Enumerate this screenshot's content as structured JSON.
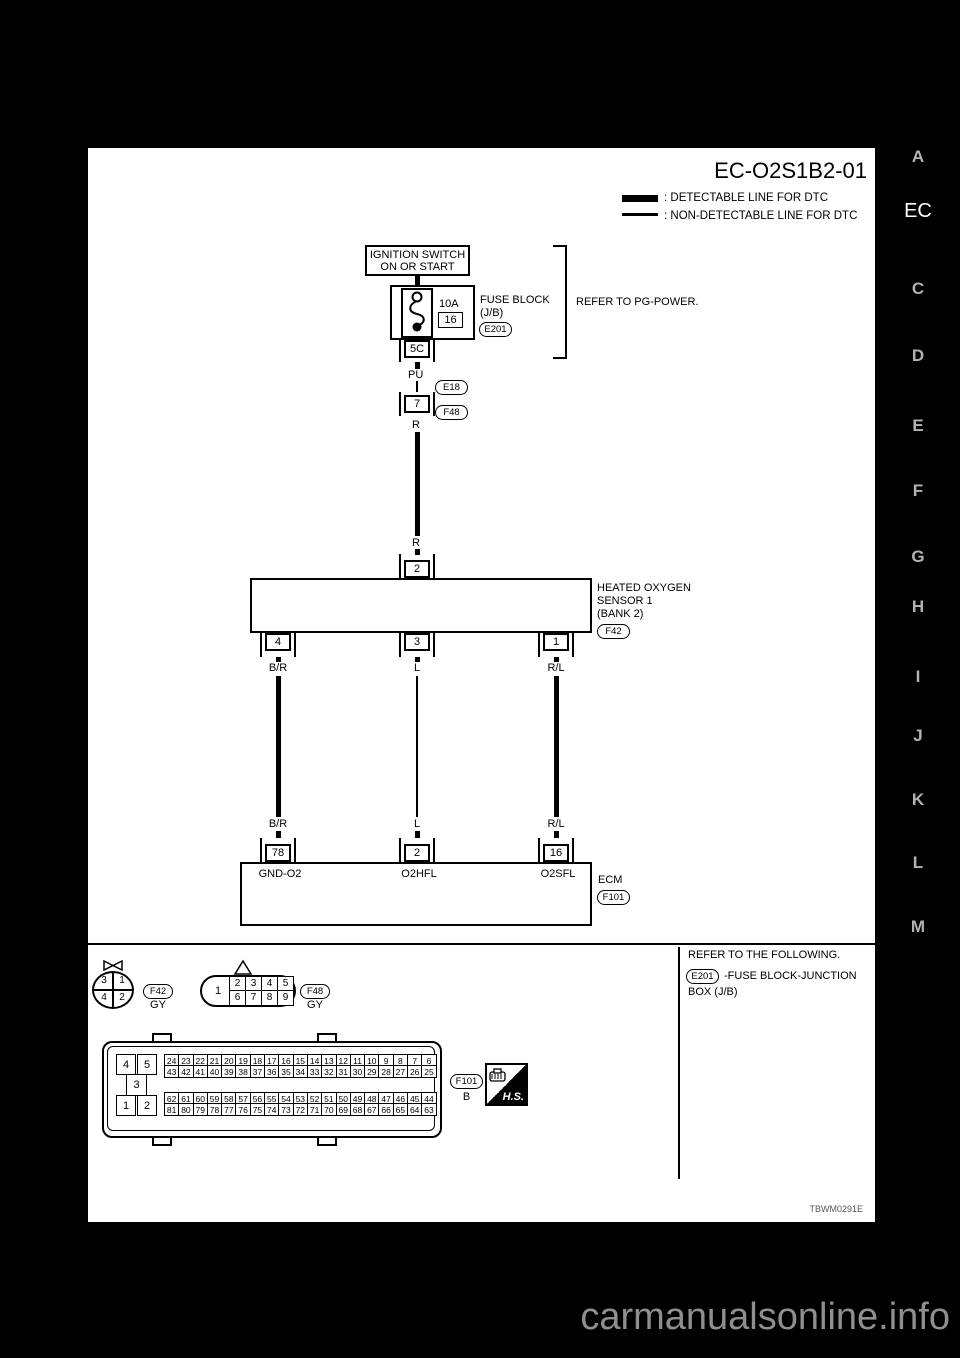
{
  "page": {
    "title": "EC-O2S1B2-01",
    "figure_code": "TBWM0291E",
    "legend": [
      {
        "style": "thick",
        "label": ": DETECTABLE LINE FOR DTC"
      },
      {
        "style": "thin",
        "label": ": NON-DETECTABLE LINE FOR DTC"
      }
    ]
  },
  "sidebar": {
    "letters": [
      "A",
      "EC",
      "C",
      "D",
      "E",
      "F",
      "G",
      "H",
      "I",
      "J",
      "K",
      "L",
      "M"
    ],
    "active": "EC"
  },
  "watermark": "carmanualsonline.info",
  "power_circuit": {
    "ignition_line1": "IGNITION SWITCH",
    "ignition_line2": "ON OR START",
    "fuse_rating": "10A",
    "fuse_no": "16",
    "block_line1": "FUSE BLOCK",
    "block_line2": "(J/B)",
    "block_connector": "E201",
    "refer_note": "REFER TO PG-POWER.",
    "jb_pin": "5C",
    "wire_top": "PU",
    "inline_pin": "7",
    "inline_upper": "E18",
    "inline_lower": "F48",
    "wire_mid": "R",
    "wire_mid2": "R"
  },
  "sensor": {
    "label_line1": "HEATED OXYGEN",
    "label_line2": "SENSOR 1",
    "label_line3": "(BANK 2)",
    "connector": "F42",
    "top_pin": "2",
    "pins": [
      {
        "pin": "4",
        "wire_top": "B/R",
        "wire_bottom": "B/R"
      },
      {
        "pin": "3",
        "wire_top": "L",
        "wire_bottom": "L"
      },
      {
        "pin": "1",
        "wire_top": "R/L",
        "wire_bottom": "R/L"
      }
    ]
  },
  "ecm": {
    "label": "ECM",
    "connector": "F101",
    "pins": [
      {
        "pin": "78",
        "name": "GND-O2"
      },
      {
        "pin": "2",
        "name": "O2HFL"
      },
      {
        "pin": "16",
        "name": "O2SFL"
      }
    ]
  },
  "connector_views": {
    "f42": {
      "id": "F42",
      "color": "GY",
      "top": [
        "3",
        "1"
      ],
      "bottom": [
        "4",
        "2"
      ]
    },
    "f48": {
      "id": "F48",
      "color": "GY",
      "left": "1",
      "top": [
        "2",
        "3",
        "4",
        "5"
      ],
      "bottom": [
        "6",
        "7",
        "8",
        "9"
      ]
    },
    "f101": {
      "id": "F101",
      "color": "B",
      "pad_top": [
        "4",
        "5"
      ],
      "pad_mid": "3",
      "pad_bottom": [
        "1",
        "2"
      ],
      "grid1_row1": [
        "24",
        "23",
        "22",
        "21",
        "20",
        "19",
        "18",
        "17",
        "16",
        "15",
        "14",
        "13",
        "12",
        "11",
        "10",
        "9",
        "8",
        "7",
        "6"
      ],
      "grid1_row2": [
        "43",
        "42",
        "41",
        "40",
        "39",
        "38",
        "37",
        "36",
        "35",
        "34",
        "33",
        "32",
        "31",
        "30",
        "29",
        "28",
        "27",
        "26",
        "25"
      ],
      "grid2_row1": [
        "62",
        "61",
        "60",
        "59",
        "58",
        "57",
        "56",
        "55",
        "54",
        "53",
        "52",
        "51",
        "50",
        "49",
        "48",
        "47",
        "46",
        "45",
        "44"
      ],
      "grid2_row2": [
        "81",
        "80",
        "79",
        "78",
        "77",
        "76",
        "75",
        "74",
        "73",
        "72",
        "71",
        "70",
        "69",
        "68",
        "67",
        "66",
        "65",
        "64",
        "63"
      ]
    },
    "hs_badge": "H.S."
  },
  "footer_note": {
    "line1": "REFER TO THE FOLLOWING.",
    "connector": "E201",
    "line2": "-FUSE BLOCK-JUNCTION",
    "line3": "BOX (J/B)"
  }
}
